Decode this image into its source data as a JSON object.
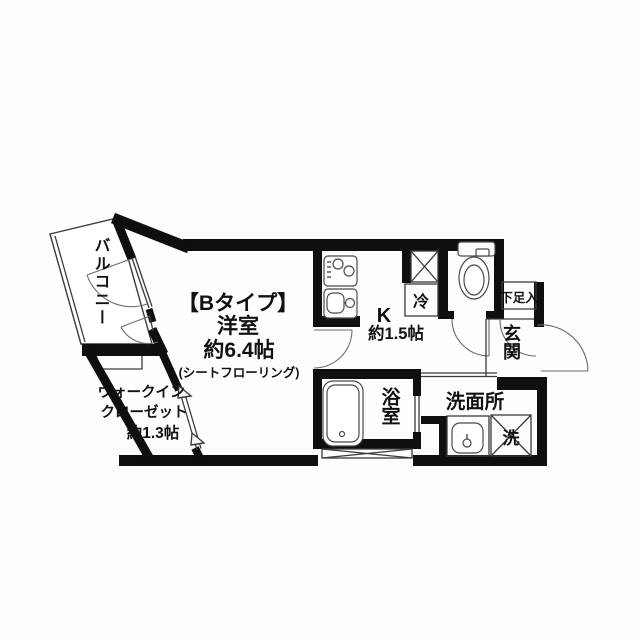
{
  "colors": {
    "wall": "#0f0f0f",
    "thin_line": "#3b3b3b",
    "door_arc": "#6a6a6a",
    "background": "#fdfdfd",
    "text": "#111111"
  },
  "labels": {
    "balcony": "バルコニー",
    "room_type": "【Bタイプ】",
    "room_name": "洋室",
    "room_size": "約6.4帖",
    "room_note": "(シートフローリング)",
    "closet_line1": "ウォークイン",
    "closet_line2": "クローゼット",
    "closet_line3": "約1.3帖",
    "kitchen": "K",
    "kitchen_size": "約1.5帖",
    "fridge": "冷",
    "shoe_cabinet": "下足入",
    "entrance": "玄関",
    "bathroom": "浴室",
    "washroom": "洗面所",
    "laundry": "洗"
  }
}
